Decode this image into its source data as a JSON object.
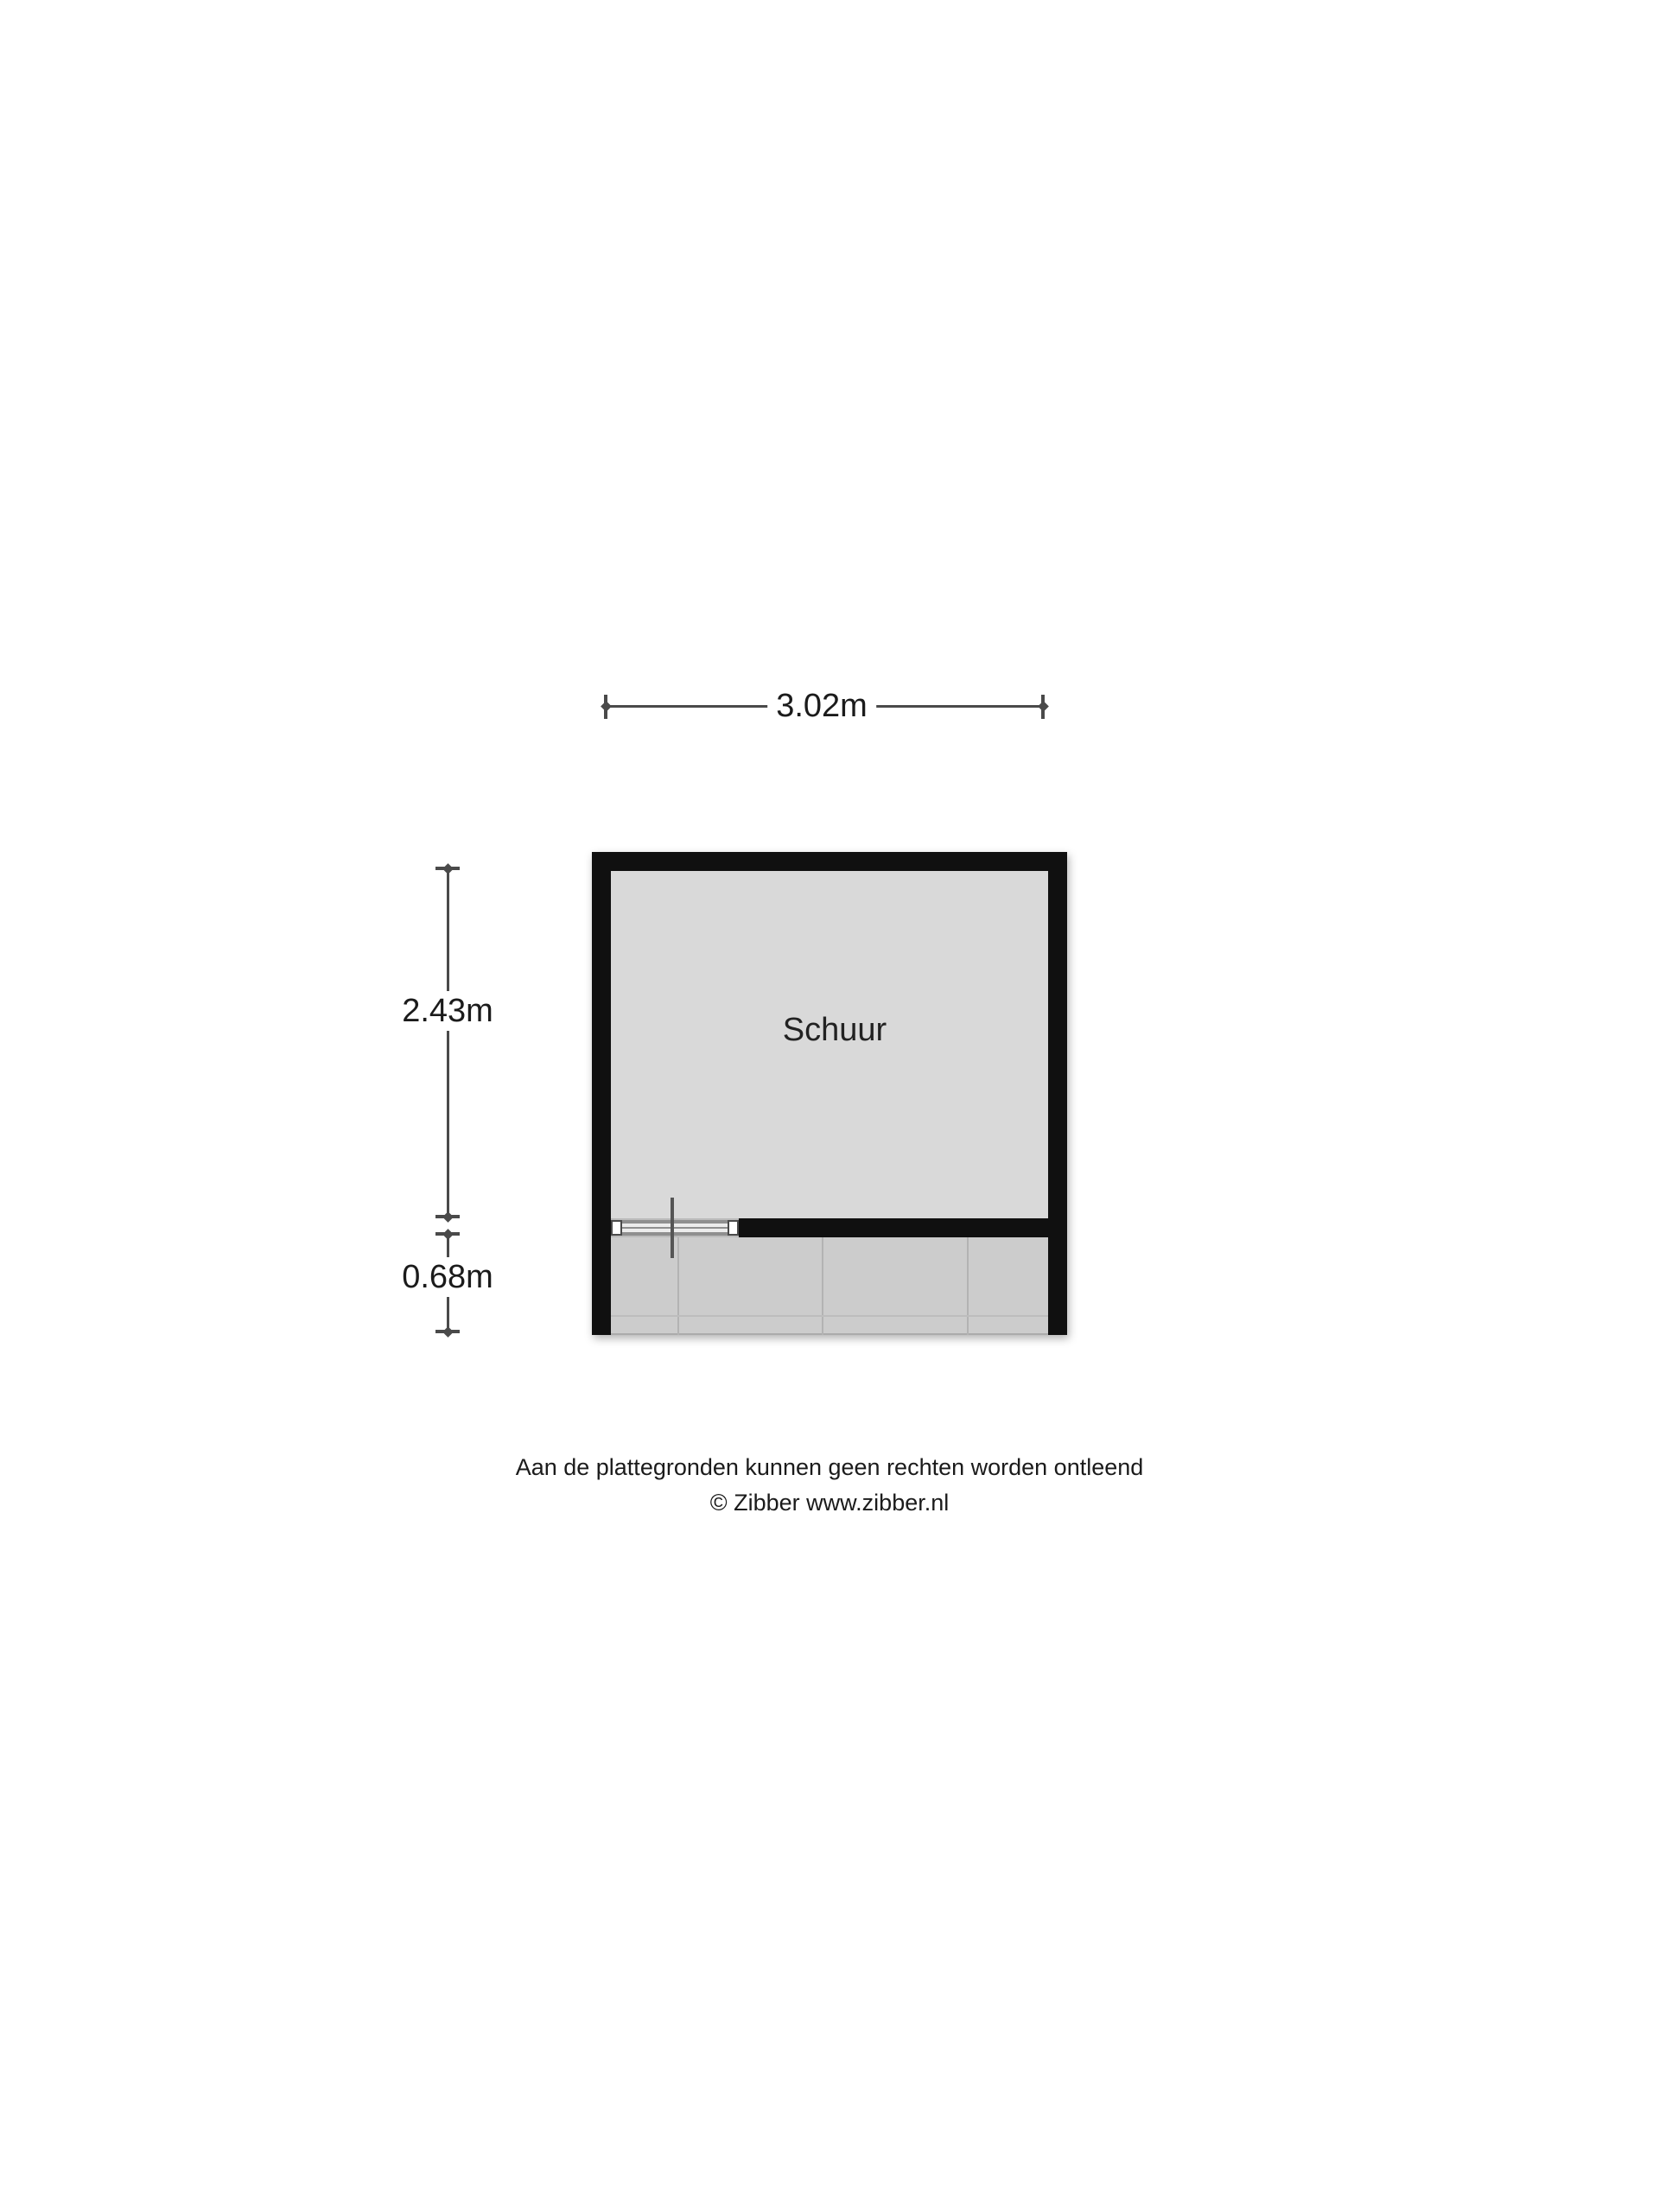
{
  "plan": {
    "room_label": "Schuur",
    "dimensions": {
      "width": "3.02m",
      "height": "2.43m",
      "porch_depth": "0.68m"
    },
    "colors": {
      "wall": "#101010",
      "room_fill": "#d9d9d9",
      "porch_fill": "#cccccc",
      "dim_line": "#4a4a4a",
      "text": "#1b1b1b",
      "background": "#ffffff"
    }
  },
  "footer": {
    "disclaimer": "Aan de plattegronden kunnen geen rechten worden ontleend",
    "copyright": "© Zibber www.zibber.nl"
  }
}
